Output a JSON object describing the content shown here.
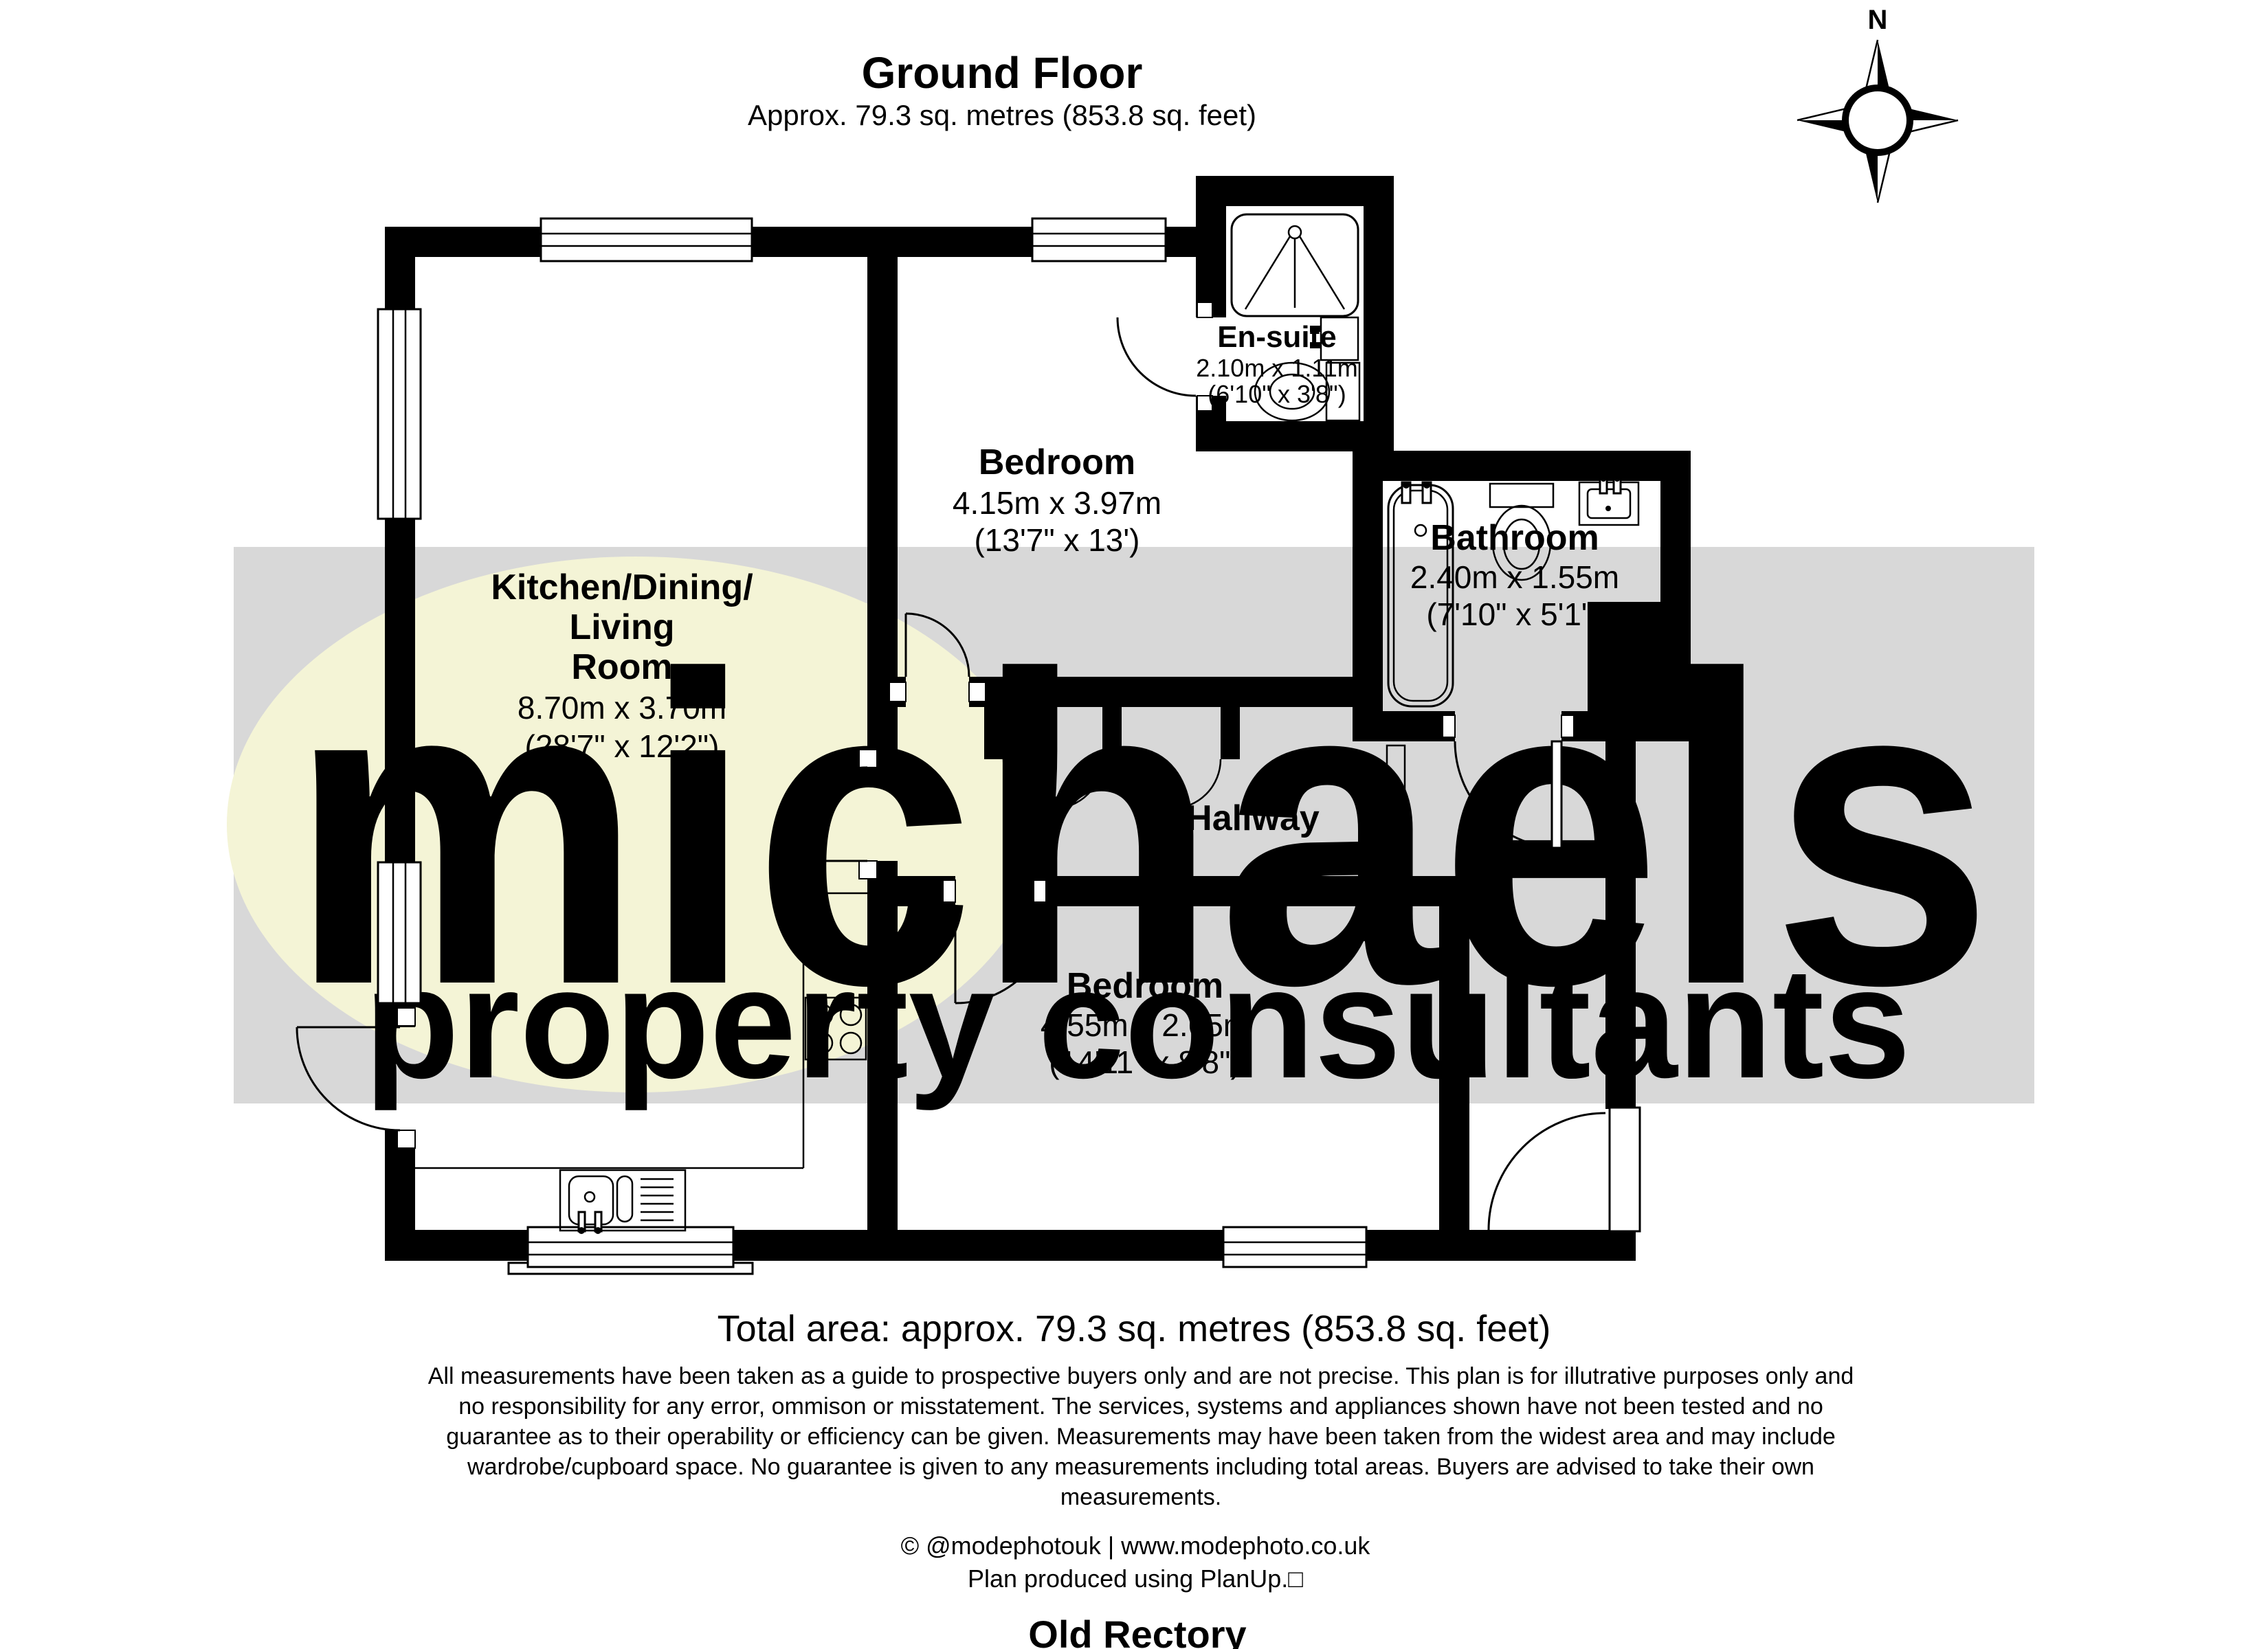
{
  "header": {
    "title": "Ground Floor",
    "subtitle": "Approx. 79.3 sq. metres (853.8 sq. feet)"
  },
  "compass": {
    "north_label": "N"
  },
  "watermark": {
    "brand": "michaels",
    "tagline": "property consultants"
  },
  "rooms": {
    "kitchen": {
      "name_line1": "Kitchen/Dining/",
      "name_line2": "Living",
      "name_line3": "Room",
      "dims_metric": "8.70m x 3.70m",
      "dims_imperial": "(28'7\" x 12'2\")"
    },
    "bedroom1": {
      "name": "Bedroom",
      "dims_metric": "4.15m x 3.97m",
      "dims_imperial": "(13'7\" x 13')"
    },
    "ensuite": {
      "name": "En-suite",
      "dims_metric": "2.10m x 1.11m",
      "dims_imperial": "(6'10\" x 3'8\")"
    },
    "bathroom": {
      "name": "Bathroom",
      "dims_metric": "2.40m x 1.55m",
      "dims_imperial": "(7'10\" x 5'1\")"
    },
    "hallway": {
      "name": "Hallway"
    },
    "bedroom2": {
      "name": "Bedroom",
      "dims_metric": "4.55m x 2.65m",
      "dims_imperial": "(14'11\" x 8'8\")"
    }
  },
  "footer": {
    "total_area": "Total area: approx. 79.3 sq. metres (853.8 sq. feet)",
    "disclaimer_lines": [
      "All measurements have been taken as a guide to prospective buyers only and are not precise. This plan is for illutrative purposes only and",
      "no responsibility for any error, ommison or misstatement. The services, systems and appliances shown have not been tested and no",
      "guarantee as to their operability or efficiency can be given. Measurements may have been taken from the widest area and may include",
      "wardrobe/cupboard space. No guarantee is given to any measurements including total areas. Buyers are advised to take their own",
      "measurements."
    ],
    "credit": "© @modephotouk | www.modephoto.co.uk",
    "produced": "Plan produced using PlanUp.□",
    "property_name": "Old Rectory"
  },
  "colors": {
    "wall": "#000000",
    "watermark_band": "#d8d8d8",
    "watermark_ellipse": "#f4f4d6",
    "watermark_brand": "#ffffff",
    "watermark_tagline": "#eaea96"
  }
}
